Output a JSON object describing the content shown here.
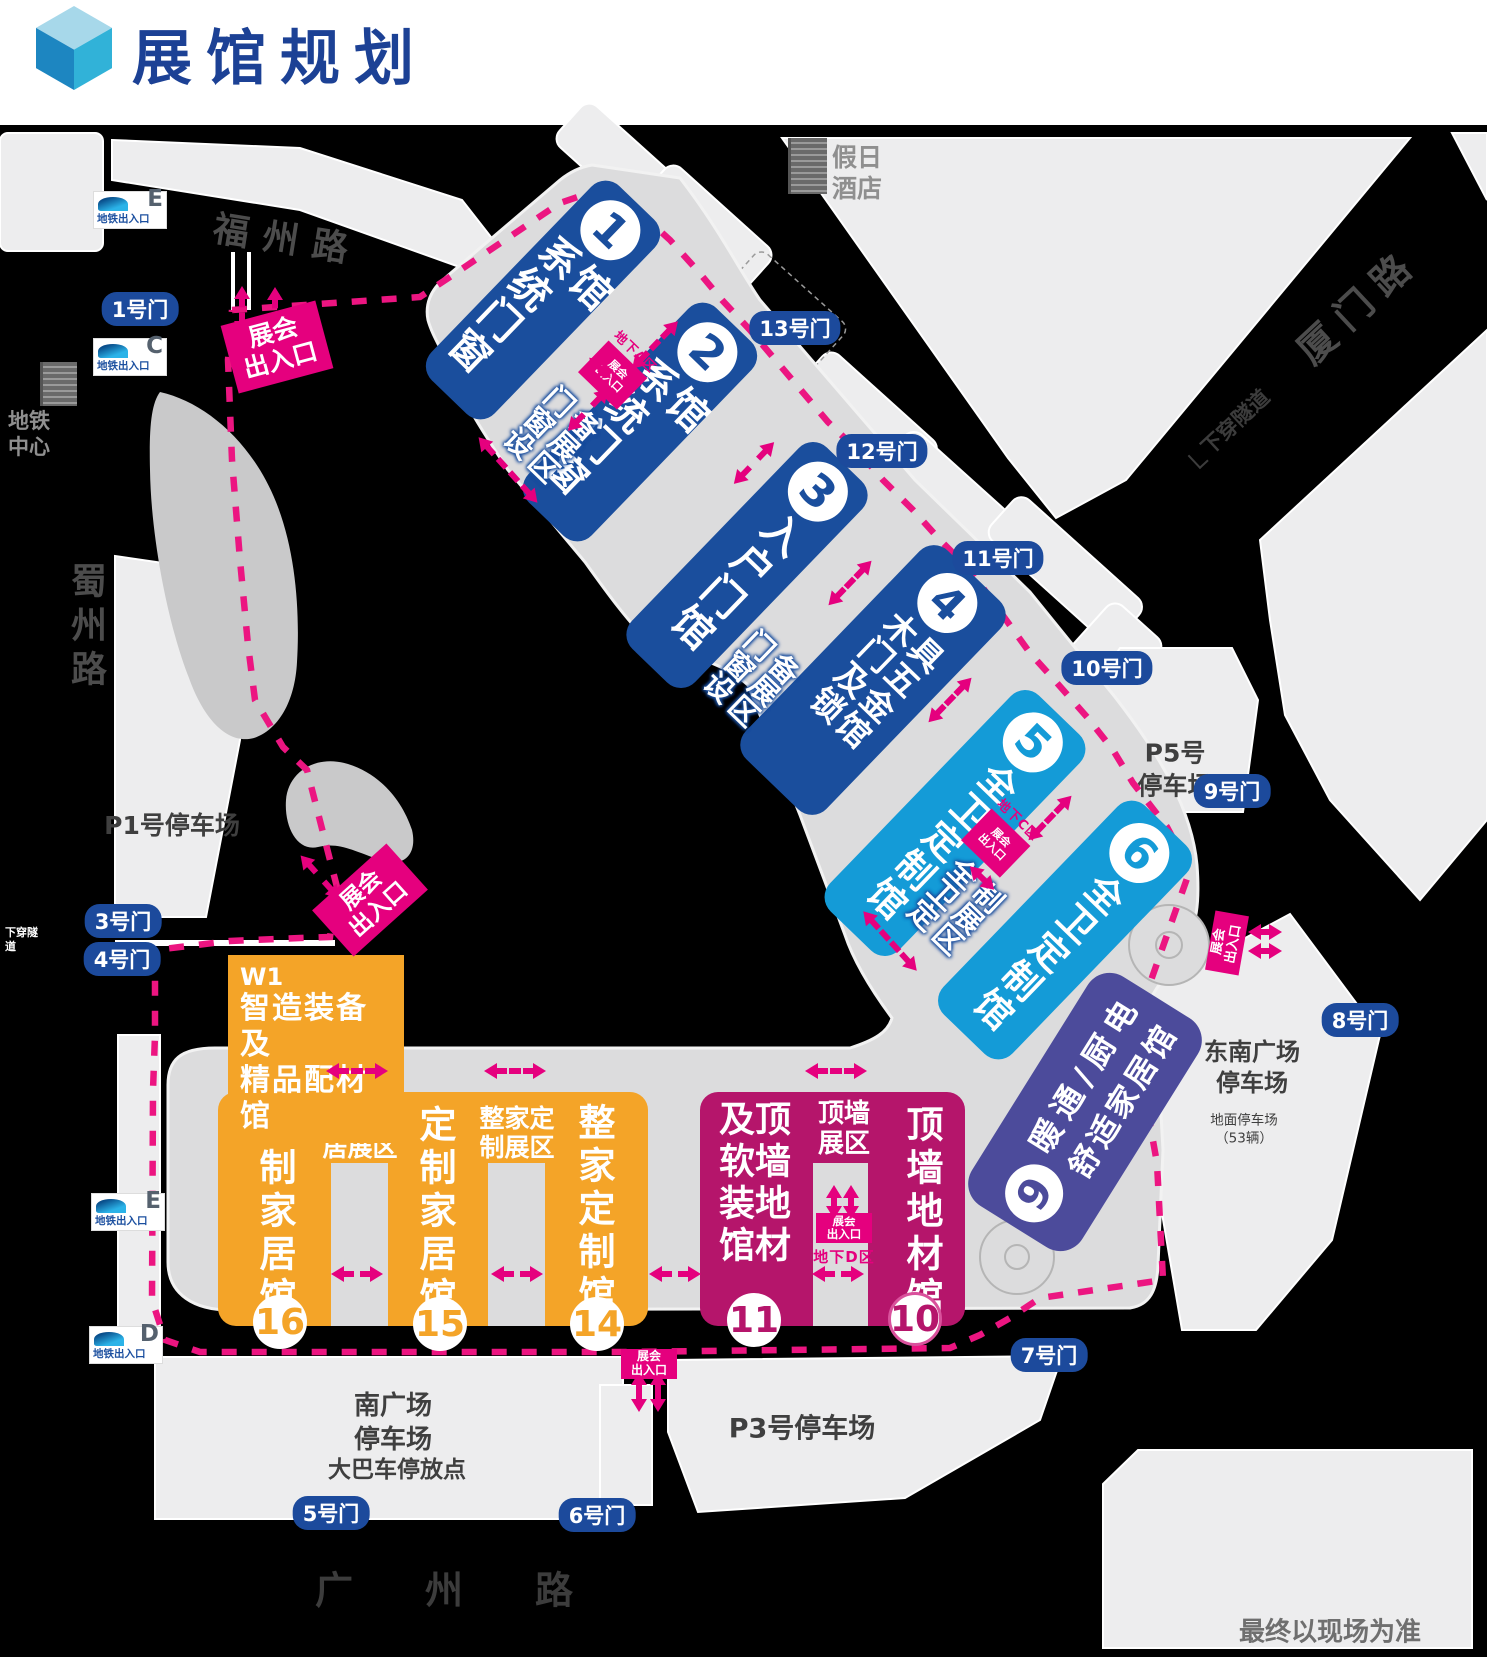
{
  "title": "展馆规划",
  "note": "最终以现场为准",
  "colors": {
    "dark_blue": "#1a4e9d",
    "light_blue": "#149bd7",
    "indigo": "#4c4b9b",
    "magenta_hall": "#b5156b",
    "orange": "#f4a428",
    "entrance_magenta": "#e5007e",
    "gate_blue": "#1c4a9c",
    "road_black": "#000000",
    "ground_gray": "#dcdcdd",
    "block_gray": "#ededee",
    "title_blue": "#1c4195"
  },
  "roads": {
    "fuzhou": "福州路",
    "xiamen": "厦门路",
    "shuzhou": "蜀州路",
    "guangzhou": "广州路",
    "tunnel_right": "下穿隧道",
    "tunnel_left": "下穿隧道"
  },
  "landmarks": {
    "hotel_line1": "假日",
    "hotel_line2": "酒店",
    "metro_center_line1": "地铁",
    "metro_center_line2": "中心"
  },
  "halls_diagonal": {
    "h1": {
      "num": "1",
      "name": "系统门窗馆"
    },
    "h2": {
      "num": "2",
      "name": "系统门窗馆"
    },
    "h3": {
      "num": "3",
      "name": "入户门馆"
    },
    "h4": {
      "num": "4",
      "name": "木门及锁具五金馆"
    },
    "h5": {
      "num": "5",
      "name": "全卫定制馆"
    },
    "h6": {
      "num": "6",
      "name": "全卫定制馆"
    }
  },
  "hall9": {
    "num": "9",
    "line1": "暖通/厨电",
    "line2": "舒适家居馆"
  },
  "halls_bottom": {
    "h10": {
      "num": "10",
      "name": "顶墙地材馆"
    },
    "h11": {
      "num": "11",
      "name": "顶墙地材及软装馆"
    },
    "h14": {
      "num": "14",
      "name": "整家定制馆"
    },
    "h15": {
      "num": "15",
      "name": "定制家居馆"
    },
    "h16": {
      "num": "16",
      "name": "定制家居馆"
    }
  },
  "w1": {
    "code": "W1",
    "line1": "智造装备及",
    "line2": "精品配材馆"
  },
  "zone_labels": {
    "z12": "门窗设备展区",
    "z34": "门窗设备展区",
    "z56": "全卫定制展区",
    "z1615_l1": "定制家",
    "z1615_l2": "居展区",
    "z1514_l1": "整家定",
    "z1514_l2": "制展区",
    "z1110_l1": "顶墙",
    "z1110_l2": "展区"
  },
  "underground": {
    "a": {
      "zone": "地下A区",
      "line1": "展会",
      "line2": "出入口"
    },
    "c": {
      "zone": "地下C区",
      "line1": "展会",
      "line2": "出入口"
    },
    "d": {
      "zone": "地下D区",
      "line1": "展会",
      "line2": "出入口"
    }
  },
  "entrances": [
    {
      "line1": "展会",
      "line2": "出入口",
      "cx": 277,
      "cy": 347,
      "rot": -15,
      "w": 98,
      "h": 70,
      "fs": 25
    },
    {
      "line1": "展会",
      "line2": "出入口",
      "cx": 370,
      "cy": 900,
      "rot": -42,
      "w": 100,
      "h": 62,
      "fs": 23
    },
    {
      "line1": "展会",
      "line2": "出入口",
      "cx": 1227,
      "cy": 943,
      "rot": -80,
      "w": 60,
      "h": 34,
      "fs": 13
    },
    {
      "line1": "展会",
      "line2": "出入口",
      "cx": 649,
      "cy": 1364,
      "rot": 0,
      "w": 56,
      "h": 30,
      "fs": 12
    }
  ],
  "gates": [
    {
      "label": "1号门",
      "x": 140,
      "y": 309
    },
    {
      "label": "3号门",
      "x": 123,
      "y": 921
    },
    {
      "label": "4号门",
      "x": 122,
      "y": 959
    },
    {
      "label": "5号门",
      "x": 331,
      "y": 1513
    },
    {
      "label": "6号门",
      "x": 597,
      "y": 1515
    },
    {
      "label": "7号门",
      "x": 1049,
      "y": 1355
    },
    {
      "label": "8号门",
      "x": 1360,
      "y": 1020
    },
    {
      "label": "9号门",
      "x": 1232,
      "y": 791
    },
    {
      "label": "10号门",
      "x": 1107,
      "y": 668
    },
    {
      "label": "11号门",
      "x": 998,
      "y": 558
    },
    {
      "label": "12号门",
      "x": 882,
      "y": 451
    },
    {
      "label": "13号门",
      "x": 795,
      "y": 328
    }
  ],
  "metro_exits": [
    {
      "letter": "E",
      "label": "地铁出入口",
      "x": 130,
      "y": 210
    },
    {
      "letter": "C",
      "label": "地铁出入口",
      "x": 130,
      "y": 357
    },
    {
      "letter": "E",
      "label": "地铁出入口",
      "x": 128,
      "y": 1212
    },
    {
      "letter": "D",
      "label": "地铁出入口",
      "x": 126,
      "y": 1345
    }
  ],
  "parking": {
    "p1": "P1号停车场",
    "p5_line1": "P5号",
    "p5_line2": "停车场",
    "p3": "P3号停车场",
    "south_line1": "南广场",
    "south_line2": "停车场",
    "bus": "大巴车停放点",
    "se_line1": "东南广场",
    "se_line2": "停车场",
    "ground_line1": "地面停车场",
    "ground_line2": "（53辆）"
  },
  "arrows": [
    {
      "x": 508,
      "y": 470,
      "rot": 48,
      "len": 88
    },
    {
      "x": 655,
      "y": 345,
      "rot": -46,
      "len": 66
    },
    {
      "x": 588,
      "y": 410,
      "rot": -46,
      "len": 58
    },
    {
      "x": 754,
      "y": 463,
      "rot": -46,
      "len": 58
    },
    {
      "x": 850,
      "y": 583,
      "rot": -46,
      "len": 62
    },
    {
      "x": 950,
      "y": 700,
      "rot": -46,
      "len": 62
    },
    {
      "x": 1050,
      "y": 818,
      "rot": -46,
      "len": 62
    },
    {
      "x": 982,
      "y": 878,
      "rot": 44,
      "len": 34
    },
    {
      "x": 600,
      "y": 368,
      "rot": 44,
      "len": 30
    },
    {
      "x": 890,
      "y": 941,
      "rot": 48,
      "len": 80
    },
    {
      "x": 320,
      "y": 877,
      "rot": 48,
      "len": 58
    },
    {
      "x": 242,
      "y": 310,
      "rot": 90,
      "len": 48
    },
    {
      "x": 275,
      "y": 311,
      "rot": 90,
      "len": 48
    },
    {
      "x": 1265,
      "y": 932,
      "rot": 0,
      "len": 34
    },
    {
      "x": 1265,
      "y": 951,
      "rot": 0,
      "len": 34
    },
    {
      "x": 639,
      "y": 1392,
      "rot": 90,
      "len": 40
    },
    {
      "x": 658,
      "y": 1392,
      "rot": 90,
      "len": 40
    },
    {
      "x": 834,
      "y": 1202,
      "rot": 90,
      "len": 34
    },
    {
      "x": 851,
      "y": 1202,
      "rot": 90,
      "len": 34
    },
    {
      "x": 357,
      "y": 1071,
      "rot": 0,
      "len": 62
    },
    {
      "x": 515,
      "y": 1071,
      "rot": 0,
      "len": 62
    },
    {
      "x": 836,
      "y": 1071,
      "rot": 0,
      "len": 62
    },
    {
      "x": 357,
      "y": 1274,
      "rot": 0,
      "len": 52
    },
    {
      "x": 517,
      "y": 1274,
      "rot": 0,
      "len": 52
    },
    {
      "x": 675,
      "y": 1274,
      "rot": 0,
      "len": 52
    },
    {
      "x": 838,
      "y": 1274,
      "rot": 0,
      "len": 52
    }
  ]
}
